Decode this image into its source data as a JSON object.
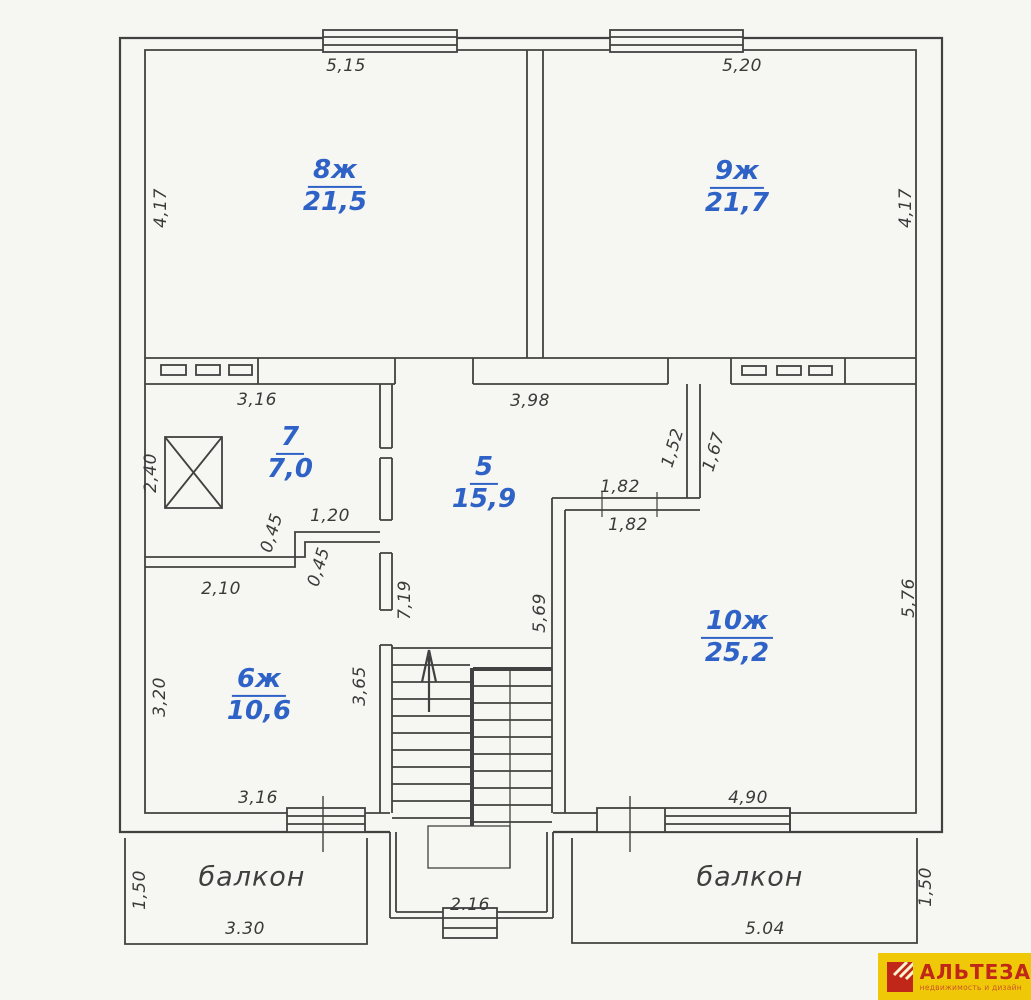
{
  "plan": {
    "rooms": [
      {
        "number": "8ж",
        "area": "21,5"
      },
      {
        "number": "9ж",
        "area": "21,7"
      },
      {
        "number": "7",
        "area": "7,0"
      },
      {
        "number": "5",
        "area": "15,9"
      },
      {
        "number": "6ж",
        "area": "10,6"
      },
      {
        "number": "10ж",
        "area": "25,2"
      }
    ],
    "balcony_left": "балкон",
    "balcony_right": "балкон",
    "dims": {
      "w_room8": "5,15",
      "w_room9": "5,20",
      "h_room8": "4,17",
      "h_room9": "4,17",
      "w_room7": "3,16",
      "w_room5": "3,98",
      "h_shaft": "2,40",
      "n_152": "1,52",
      "n_167": "1,67",
      "n_182a": "1,82",
      "n_182b": "1,82",
      "n_120": "1,20",
      "n_045a": "0,45",
      "n_045b": "0,45",
      "n_210": "2,10",
      "h_corridor": "7,19",
      "h_room10_left": "5,69",
      "h_room10_right": "5,76",
      "h_room6_left": "3,20",
      "h_room6_right": "3,65",
      "w_room6": "3,16",
      "w_room10": "4,90",
      "h_balcony_left": "1,50",
      "w_balcony_left": "3.30",
      "w_stairbay": "2.16",
      "w_balcony_right": "5.04",
      "h_balcony_right": "1,50"
    }
  },
  "logo": {
    "name": "АЛЬТЕЗА",
    "tagline": "недвижимость и дизайн"
  }
}
